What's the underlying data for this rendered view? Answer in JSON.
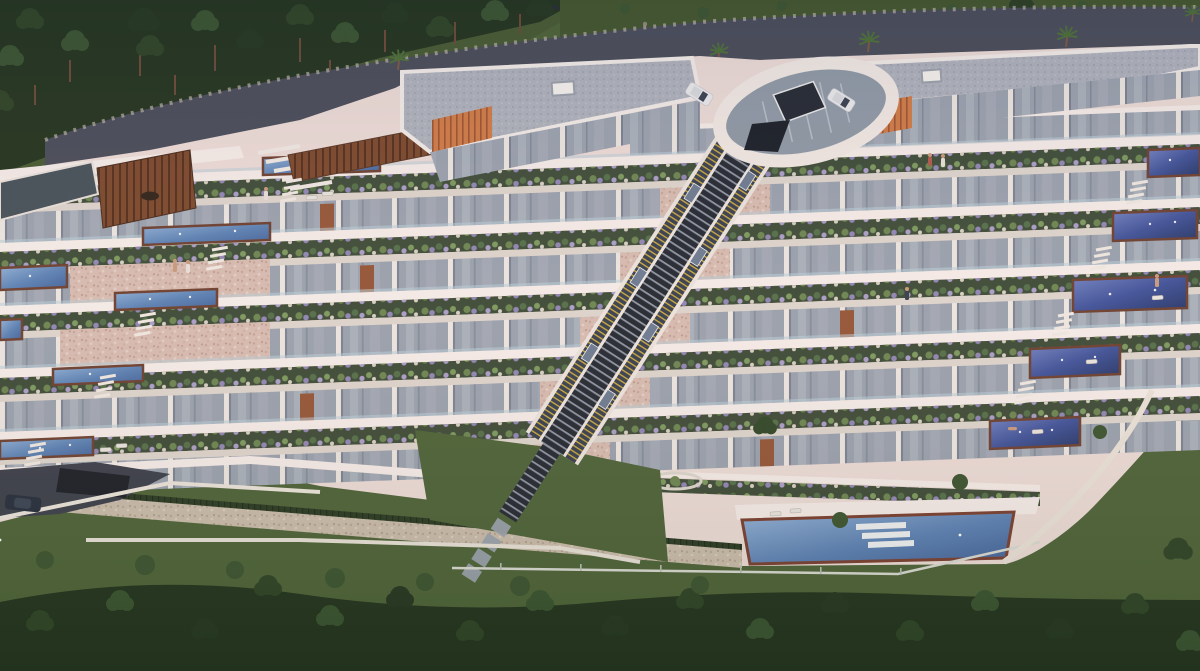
{
  "scene": {
    "type": "architectural-aerial-render",
    "time_of_day": "dusk",
    "description": "Aerial dusk rendering of a terraced hillside apartment complex: a curving dark road with pine forest above, a circular entrance plaza with a glass funicular station, two flat-roofed top buildings with orange timber slats, six stepped garden terraces with planters and glass facades, a central inclined funicular stair spine, light-blue private pools on the left wing, deep-blue pools on the right wing, a long communal pool with white steps at the garden level, white retaining walls, lawns and dense trees below.",
    "elements": {
      "terrace_levels": 6,
      "pools_left_wing": 7,
      "pools_right_wing": 5,
      "communal_pool_with_steps": 1,
      "funicular_tracks": 1,
      "circular_entrance_plaza": 1,
      "rooftop_skylights": 2,
      "parked_cars_white": 2,
      "car_dark": 1,
      "palm_trees": 5,
      "people": 8
    }
  },
  "palette": {
    "road": "#4a4d5a",
    "roadEdge": "#b2ada1",
    "forestDark": "#24351f",
    "treeA": "#2f4527",
    "treeB": "#3a5431",
    "treeC": "#263822",
    "lawn": "#4e6439",
    "lawnDark": "#44572f",
    "hedge": "#2c3c25",
    "wallBase": "#ecdcd7",
    "parapet": "#f5ece8",
    "wallShadow": "#d9c7c2",
    "stone": "#d7bcb1",
    "stoneDot": "#c3a496",
    "stoneGray": "#c9bcab",
    "glass": "#9aa2ae",
    "glassLight": "#b3bac3",
    "glassDark": "#47525a",
    "planterBase": "#3f4d39",
    "plantGreen1": "#6d8652",
    "plantGreen2": "#55704a",
    "plantPurple1": "#9187b5",
    "plantPurple2": "#ab9fc8",
    "rock": "#d8d1c4",
    "poolLight1": "#93b3d8",
    "poolLight2": "#44639a",
    "poolDark1": "#7283c2",
    "poolDark2": "#273868",
    "wood": "#6e4232",
    "orange": "#d07c48",
    "pergola": "#7c4a2e",
    "track": "#262b34",
    "rung": "#8f96a2",
    "tread": "#c9a93f",
    "stair": "#3a4150",
    "roof": "#aeb2bc",
    "roofDot": "#9a9ea8",
    "paving": "#ddd5cd",
    "slate": "#58606e",
    "balustrade": "#b9cdd9",
    "stairWhite": "#efe8e2",
    "carWhite": "#e9eaec",
    "carDark": "#27303e",
    "skin": "#c89b7e"
  }
}
